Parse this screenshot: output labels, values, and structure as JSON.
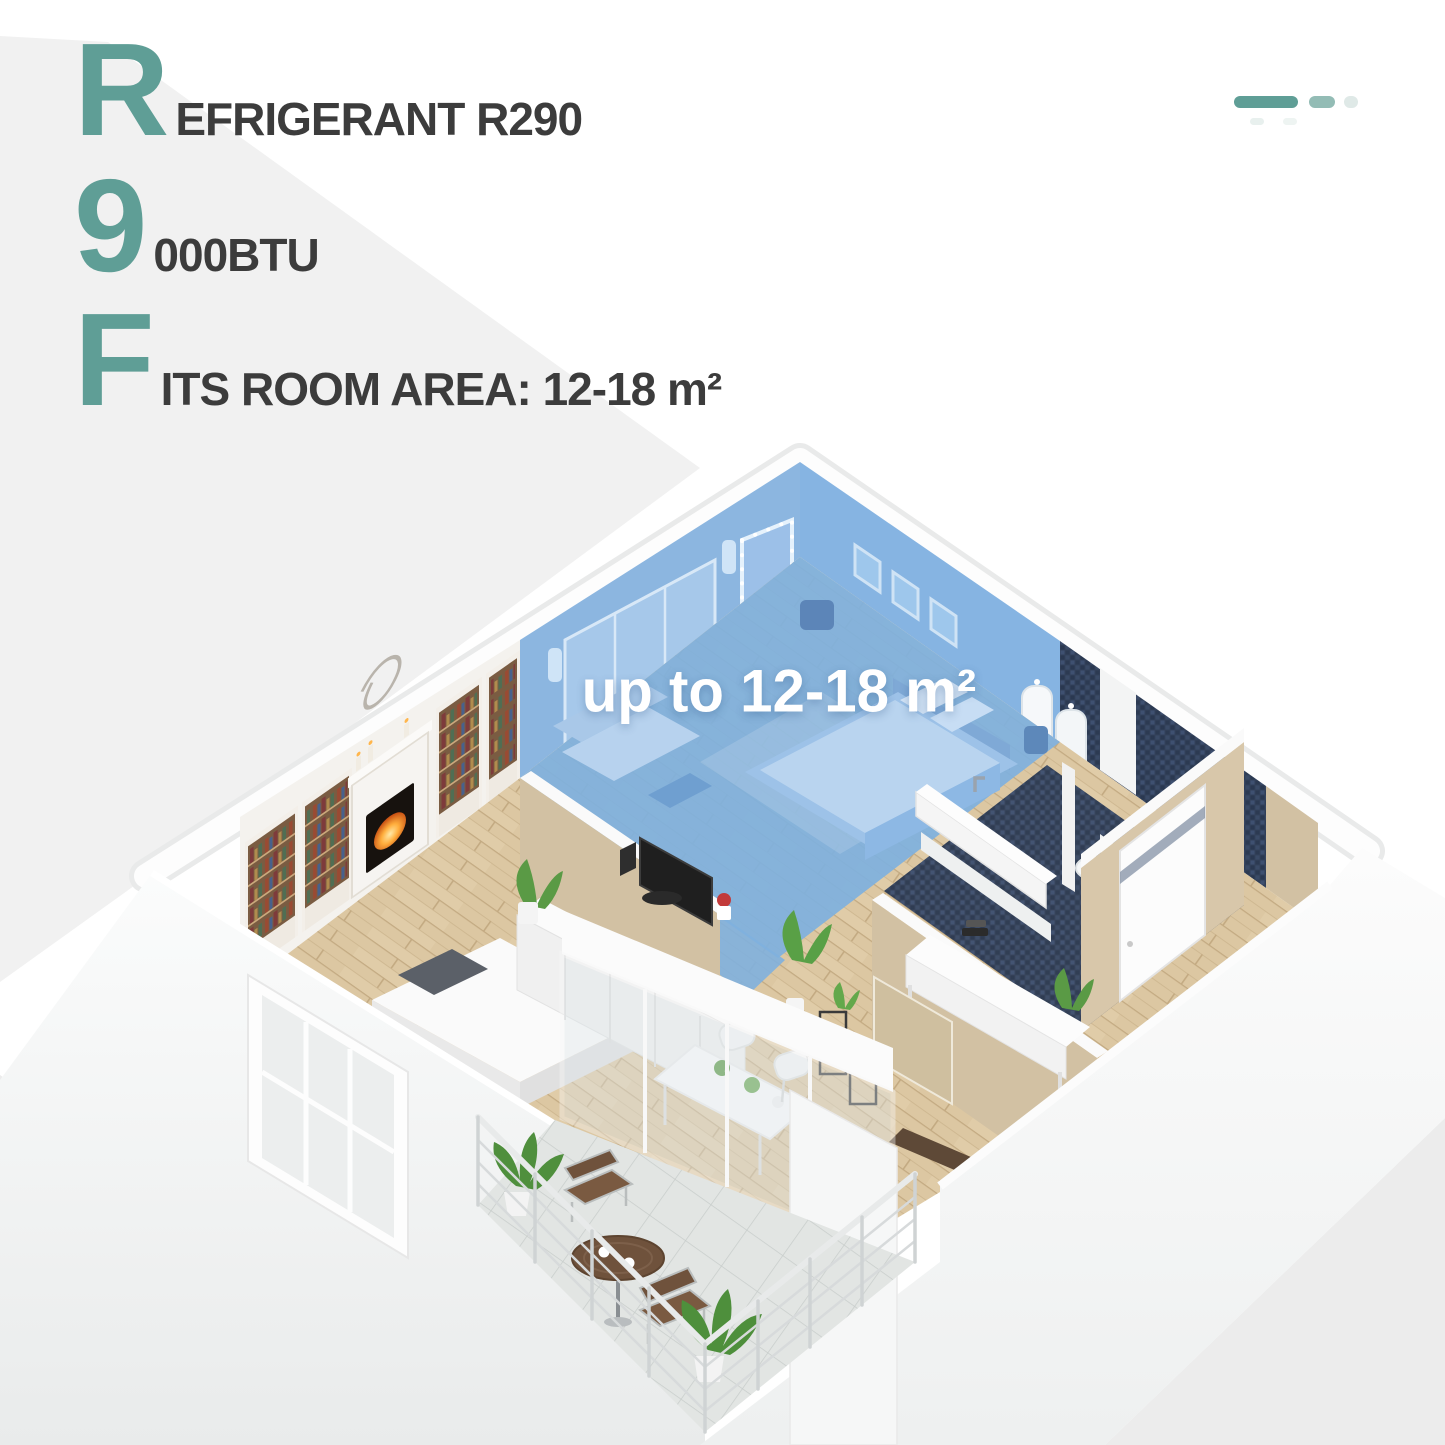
{
  "header": {
    "features": [
      {
        "big": "R",
        "rest": "EFRIGERANT R290"
      },
      {
        "big": "9",
        "rest": "000BTU"
      },
      {
        "big": "F",
        "rest": "ITS ROOM AREA: 12-18 m²"
      }
    ]
  },
  "floorplan": {
    "area_label": "up to 12-18 m²",
    "highlighted_room": "bedroom",
    "rooms_depicted": [
      "bedroom-highlighted-blue",
      "living-room",
      "bathroom",
      "toilet",
      "hallway",
      "dining-area",
      "balcony"
    ]
  },
  "decor": {
    "pill_colors": [
      "#5f9e96",
      "#93bcb5",
      "#dfe9e7"
    ]
  },
  "palette": {
    "teal": "#5f9e96",
    "tealLight": "#93bcb5",
    "tealFaint": "#dfe9e7",
    "textDark": "#3c3c3c",
    "bgGray": "#f1f1f1",
    "blueWall": "#8cb6e0",
    "blueWall2": "#86b4e2",
    "blueFloor": "#7fb0de",
    "navy": "#33415a",
    "beige": "#d2c1a3",
    "wood": "#dcc7a2",
    "labelWhite": "#ffffff"
  }
}
